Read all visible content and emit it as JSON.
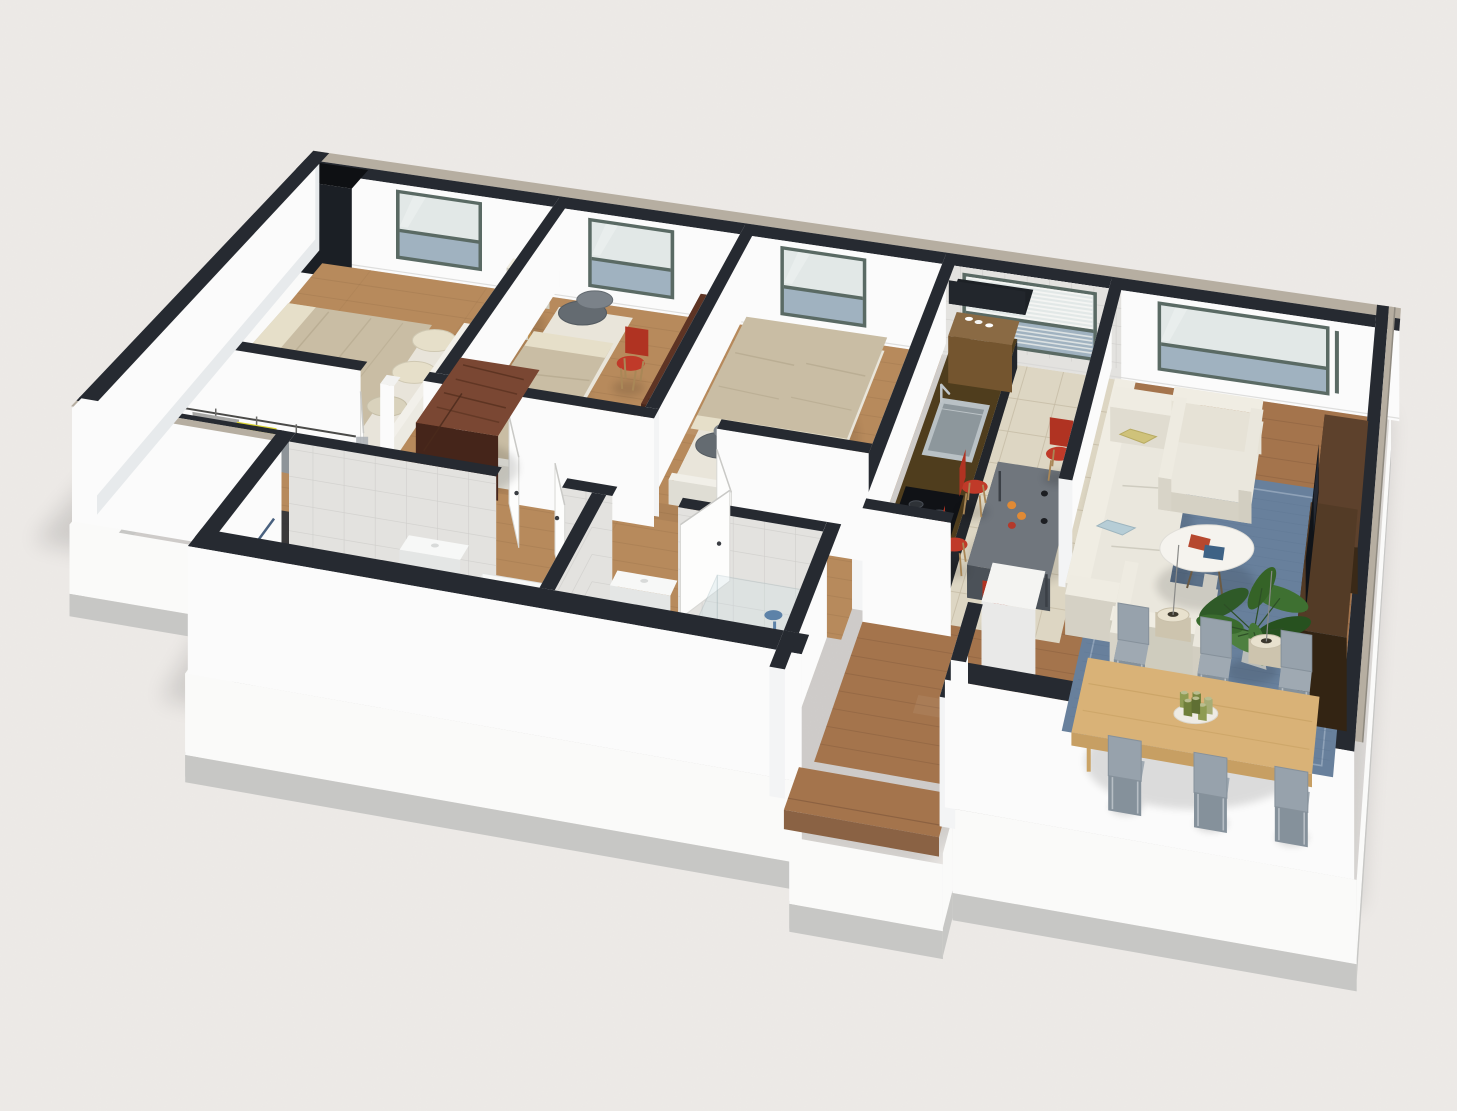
{
  "scene": {
    "title": "3D isometric apartment floor plan render",
    "style": "cutaway-axonometric",
    "rooms": [
      {
        "id": "master-bedroom",
        "label": "Master bedroom",
        "furniture": [
          "double-bed",
          "beige-blanket",
          "cream-pillows",
          "armchair",
          "mahogany-dresser",
          "window"
        ]
      },
      {
        "id": "bedroom-2",
        "label": "Bedroom 2",
        "furniture": [
          "single-bed",
          "gray-pillows",
          "desk",
          "red-desk-chair",
          "window"
        ]
      },
      {
        "id": "bedroom-3",
        "label": "Bedroom 3",
        "furniture": [
          "twin-bed-left",
          "twin-bed-right",
          "gray-pillows",
          "window"
        ]
      },
      {
        "id": "kitchen",
        "label": "Kitchen",
        "furniture": [
          "counter-with-sink",
          "cooktop",
          "wall-shelf-with-cups",
          "louvered-window",
          "gray-table",
          "red-chairs",
          "fruit"
        ]
      },
      {
        "id": "living-room",
        "label": "Living room",
        "furniture": [
          "sofa",
          "yellow-pillow",
          "blue-pillow",
          "armchair-back",
          "armchair-front",
          "round-coffee-table",
          "magazines",
          "blue-rug",
          "potted-plant",
          "tv-cabinet",
          "tv",
          "picture-window",
          "pendant-lamps"
        ]
      },
      {
        "id": "dining-area",
        "label": "Dining area",
        "furniture": [
          "wood-dining-table",
          "gray-chairs-6",
          "candle-centerpiece"
        ]
      },
      {
        "id": "bathroom-1",
        "label": "Bathroom with bathtub",
        "furniture": [
          "vanity-sink",
          "toilet",
          "bathtub"
        ]
      },
      {
        "id": "bathroom-2",
        "label": "Bathroom with shower",
        "furniture": [
          "toilet",
          "square-sink",
          "shower-column",
          "shower-glass"
        ]
      },
      {
        "id": "hallway",
        "label": "Hallway",
        "furniture": [
          "open-white-doors"
        ]
      },
      {
        "id": "walk-in-closet",
        "label": "Walk-in closet",
        "furniture": [
          "clothes-rail",
          "gray-coat",
          "yellow-jacket",
          "gray-shirt"
        ]
      },
      {
        "id": "entry-porch",
        "label": "Entry porch",
        "furniture": [
          "wood-step"
        ]
      }
    ],
    "palette": {
      "background": "#edeae7",
      "ground_shadow": "#000000",
      "wall_white": "#fbfbfb",
      "wall_face_light": "#f3f4f5",
      "wall_inner_gray": "#e7eaec",
      "cap_dark": "#262a31",
      "cap_beige": "#b6aea1",
      "cap_beige_light": "#cfc8bc",
      "fascia_white": "#fafaf9",
      "plinth_gray": "#c7c7c5",
      "wood_bedroom": "#b78a5c",
      "wood_bedroom_line": "#97704a",
      "wood_living": "#a4744c",
      "wood_living_line": "#7d563a",
      "tile_kitchen": "#ddd6c3",
      "tile_bath": "#e7dfcb",
      "tile_grout": "#c6bca6",
      "tile_wall": "#e3e2df",
      "window_frame": "#5a6a64",
      "glass_light": "#e2e8e7",
      "glass_blue": "#a0b2c0",
      "counter_top": "#4f3d1d",
      "cabinet_dark": "#23262b",
      "cooktop": "#101216",
      "sink_steel": "#b9c1c5",
      "red_chair": "#c03a29",
      "kitchen_table": "#70767d",
      "orange_fruit": "#e08a35",
      "sofa_cream": "#eae7dd",
      "pillow_yellow": "#cfc27a",
      "pillow_blue": "#b6cdd6",
      "pillow_gray": "#646b71",
      "rug_blue": "#68809c",
      "coffee_table": "#f5f3ee",
      "tv_brown": "#46301f",
      "tv_screen": "#101318",
      "plant_green": "#3e7031",
      "dining_table": "#d9b277",
      "dining_chair": "#9fa9b2",
      "blanket_beige": "#c9bda4",
      "sheet_cream": "#e6dfc9",
      "mahogany": "#5e3424",
      "fixture_white": "#f7f8f7",
      "shower_blue": "#5d82a8",
      "clothes_gray": "#a7a7a5",
      "clothes_yellow": "#d9d32f",
      "lamp_cream": "#e8e1ce"
    }
  }
}
